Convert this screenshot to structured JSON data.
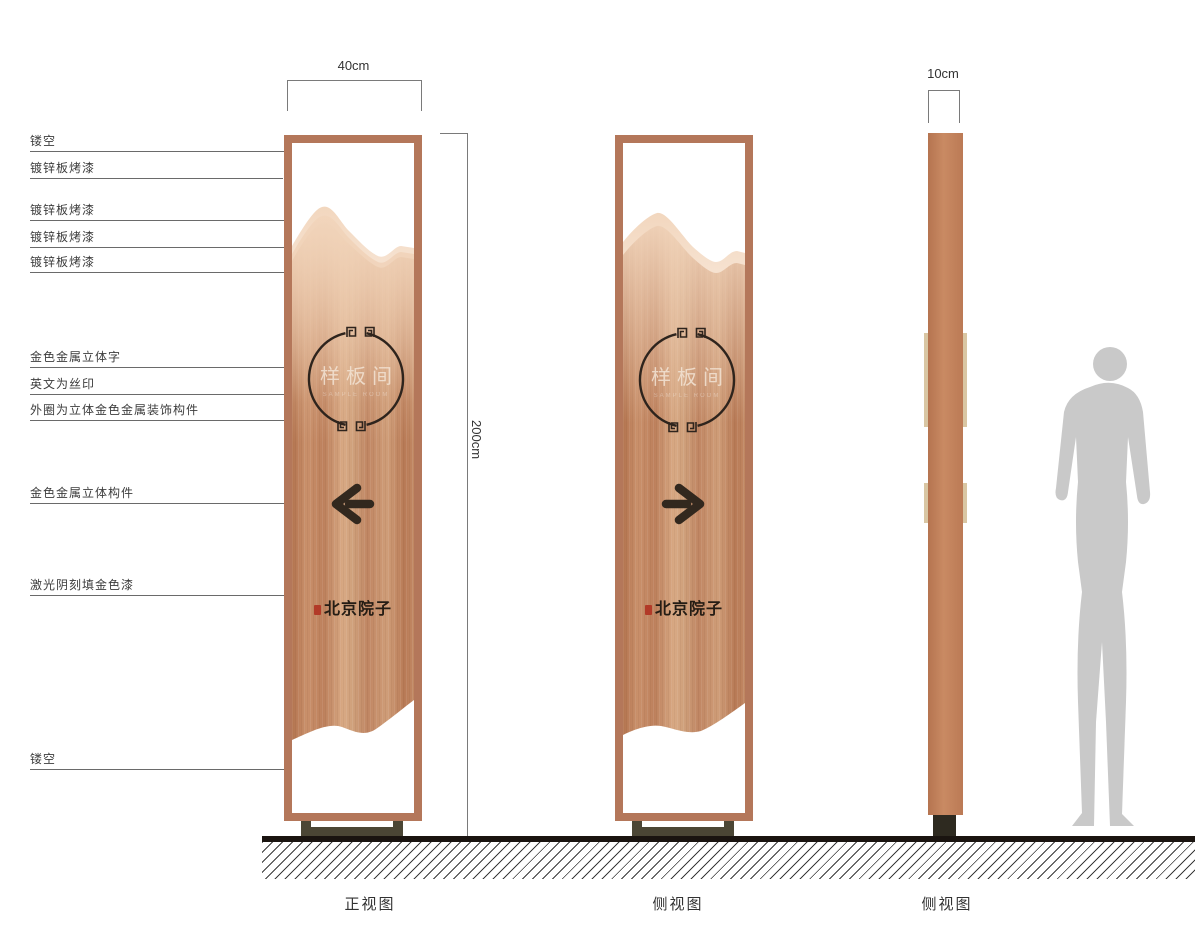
{
  "callouts": [
    {
      "label": "镂空"
    },
    {
      "label": "镀锌板烤漆"
    },
    {
      "label": "镀锌板烤漆"
    },
    {
      "label": "镀锌板烤漆"
    },
    {
      "label": "镀锌板烤漆"
    },
    {
      "label": "金色金属立体字"
    },
    {
      "label": "英文为丝印"
    },
    {
      "label": "外圈为立体金色金属装饰构件"
    },
    {
      "label": "金色金属立体构件"
    },
    {
      "label": "激光阴刻填金色漆"
    },
    {
      "label": "镂空"
    }
  ],
  "dimensions": {
    "front_width": "40cm",
    "height": "200cm",
    "side_width": "10cm"
  },
  "signs": {
    "room_name": "样板间",
    "room_name_en": "SAMPLE ROOM",
    "brand": "北京院子"
  },
  "view_labels": {
    "front": "正视图",
    "side1": "侧视图",
    "side2": "侧视图"
  },
  "icons": {
    "front_arrow": "arrow-left-icon",
    "side_arrow": "arrow-right-icon"
  },
  "colors": {
    "frame": "#b4775a",
    "panel_base": "#c68e6b",
    "mountain_light": "#f2d6bd",
    "mountain_mid": "#e9c2a1",
    "ring": "#2e241d",
    "arrow": "#32281e",
    "emblem_text": "#f3e4d5",
    "brand_text": "#241c14",
    "seal_red": "#b23a28",
    "base_stand": "#4b4635",
    "ground": "#1a1410",
    "tab_beige": "#d9c6a3",
    "silhouette": "#c9c9c9",
    "label_text": "#3c3c3c"
  }
}
